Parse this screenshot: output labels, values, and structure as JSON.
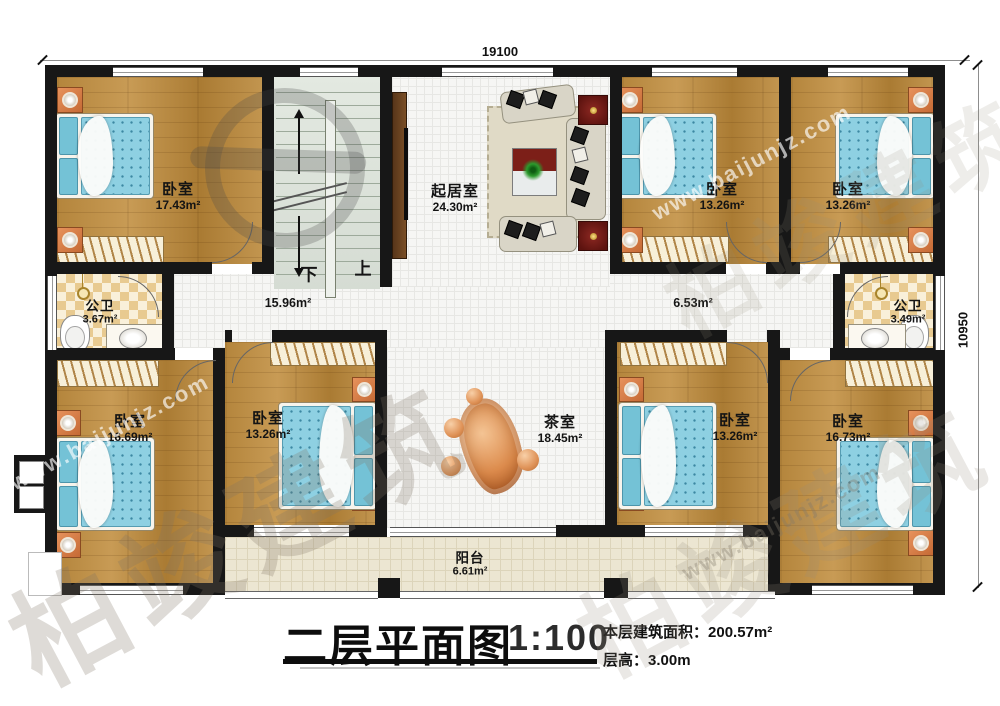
{
  "watermark": {
    "brand": "柏竣建筑",
    "url": "www.baijunjz.com"
  },
  "dimensions": {
    "width": "19100",
    "height": "10950"
  },
  "stairs": {
    "down": "下",
    "up": "上"
  },
  "corridors": [
    {
      "area": "15.96m²"
    },
    {
      "area": "6.53m²"
    }
  ],
  "rooms": [
    {
      "name": "卧室",
      "area": "17.43m²"
    },
    {
      "name": "起居室",
      "area": "24.30m²"
    },
    {
      "name": "卧室",
      "area": "13.26m²"
    },
    {
      "name": "卧室",
      "area": "13.26m²"
    },
    {
      "name": "公卫",
      "area": "3.67m²"
    },
    {
      "name": "公卫",
      "area": "3.49m²"
    },
    {
      "name": "卧室",
      "area": "16.69m²"
    },
    {
      "name": "卧室",
      "area": "13.26m²"
    },
    {
      "name": "茶室",
      "area": "18.45m²"
    },
    {
      "name": "卧室",
      "area": "13.26m²"
    },
    {
      "name": "卧室",
      "area": "16.73m²"
    },
    {
      "name": "阳台",
      "area": "6.61m²"
    }
  ],
  "title_block": {
    "title": "二层平面图",
    "scale": "1:100",
    "area_label": "本层建筑面积：",
    "area_value": "200.57m²",
    "floor_height_label": "层高：",
    "floor_height_value": "3.00m"
  }
}
